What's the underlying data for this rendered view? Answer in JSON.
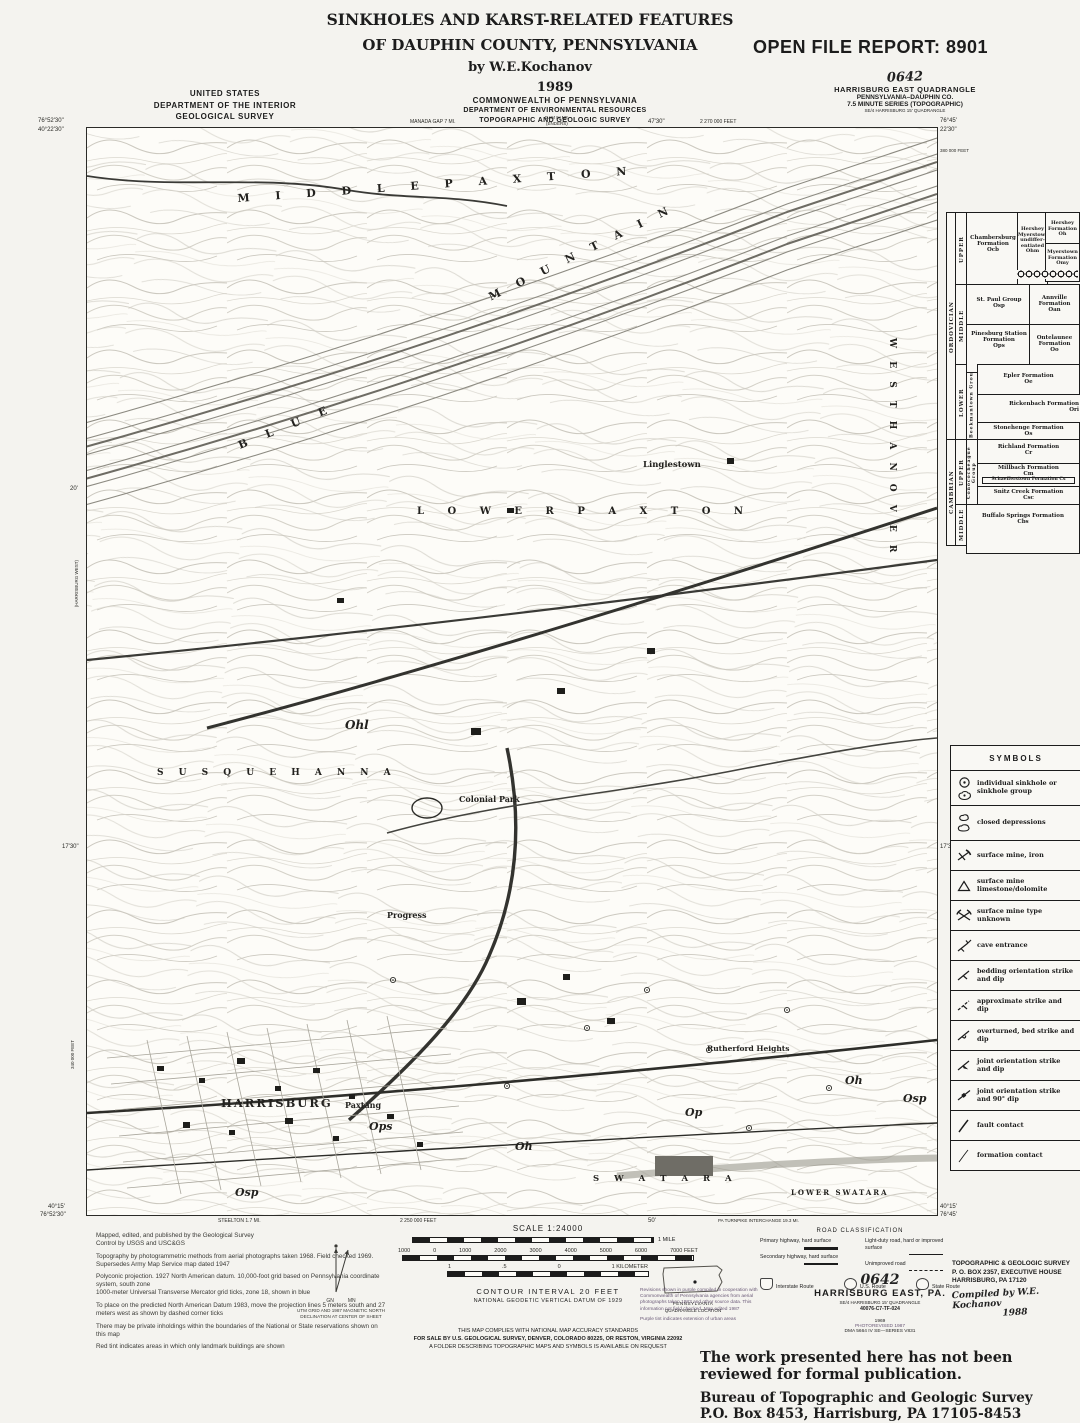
{
  "title_block": {
    "line1": "SINKHOLES AND KARST-RELATED FEATURES",
    "line2": "OF DAUPHIN COUNTY, PENNSYLVANIA",
    "byline": "by  W.E.Kochanov"
  },
  "open_file_report": "OPEN FILE REPORT: 8901",
  "agency_left": {
    "line1": "UNITED STATES",
    "line2": "DEPARTMENT OF THE INTERIOR",
    "line3": "GEOLOGICAL SURVEY"
  },
  "agency_center": {
    "year": "1989",
    "line1": "COMMONWEALTH OF PENNSYLVANIA",
    "line2": "DEPARTMENT OF ENVIRONMENTAL RESOURCES",
    "line3": "TOPOGRAPHIC AND GEOLOGIC SURVEY"
  },
  "quad_block": {
    "code": "0642",
    "line1": "HARRISBURG EAST QUADRANGLE",
    "line2": "PENNSYLVANIA–DAUPHIN CO.",
    "line3": "7.5 MINUTE SERIES (TOPOGRAPHIC)",
    "line4": "SE/4 HARRISBURG 15' QUADRANGLE"
  },
  "map": {
    "corners": {
      "nw_lon": "76°52'30\"",
      "nw_lat": "40°22'30\"",
      "ne_lon": "76°45'",
      "ne_lat": "22'30\"",
      "sw_lat": "40°15'",
      "sw_lon": "76°52'30\"",
      "se_lat": "40°15'",
      "se_lon": "76°45'"
    },
    "edge_ticks": {
      "top_left": "MANADA GAP 7 MI.",
      "top_quad1": "DAM IV NE",
      "top_quad2": "(ENDERS)",
      "top_center": "47'30\"",
      "top_feet": "2 270 000 FEET",
      "left_upper": "20'",
      "left_lower": "17'30\"",
      "left_feet": "340 000 FEET",
      "left_quad": "(HARRISBURG WEST)",
      "right_feet": "380 000 FEET",
      "right_mid": "17'30\"",
      "bottom_a": "STEELTON 1.7 MI.",
      "bottom_b": "2 250 000 FEET",
      "bottom_c": "50'",
      "bottom_d": "PA TURNPIKE INTERCHANGE 19.3 MI."
    },
    "labels": {
      "township_top": "M I D D L E   P A X T O N",
      "ridge1": "B L U E",
      "ridge2": "M O U N T A I N",
      "town1": "Linglestown",
      "township_mid": "L O W E R   P A X T O N",
      "township_right": "W E S T   H A N O V E R",
      "township_left": "S U S Q U E H A N N A",
      "town2": "Colonial Park",
      "town3": "Progress",
      "city": "HARRISBURG",
      "town4": "Paxtang",
      "town5": "Rutherford Heights",
      "township_bottom": "S W A T A R A",
      "township_br": "LOWER SWATARA"
    },
    "annotations": {
      "a1": "Ohl",
      "a2": "Ops",
      "a3": "Osp",
      "a4": "Oh",
      "a5": "Op",
      "a6": "Osp",
      "a7": "Oh"
    }
  },
  "strat": {
    "era1": "ORDOVICIAN",
    "era2": "CAMBRIAN",
    "epoch1": "UPPER",
    "epoch2": "MIDDLE",
    "epoch3": "LOWER",
    "epoch4": "UPPER",
    "epoch5": "MIDDLE",
    "group1": "Beekmantown Group",
    "group2": "Conococheague Group",
    "f1": "Chambersburg Formation",
    "f1c": "Ocb",
    "f2": "Hershey Myerstown undiffer- entiated",
    "f2c": "Ohm",
    "f3": "Hershey Formation",
    "f3c": "Oh",
    "f4": "Myerstown Formation",
    "f4c": "Omy",
    "f5": "St. Paul Group",
    "f5c": "Osp",
    "f6": "Annville Formation",
    "f6c": "Oan",
    "f7": "Pinesburg Station Formation",
    "f7c": "Ops",
    "f8": "Ontelaunee Formation",
    "f8c": "Oo",
    "f9": "Epler Formation",
    "f9c": "Oe",
    "f10": "Rickenbach Formation",
    "f10c": "Ori",
    "f11": "Stonehenge Formation",
    "f11c": "Os",
    "f12": "Richland Formation",
    "f12c": "Cr",
    "f13": "Millbach Formation",
    "f13c": "Cm",
    "f14": "Schaefferstown Formation",
    "f14c": "Cs",
    "f15": "Snitz Creek Formation",
    "f15c": "Csc",
    "f16": "Buffalo Springs Formation",
    "f16c": "Cbs"
  },
  "symbols_legend": {
    "title": "SYMBOLS",
    "items": [
      {
        "icon": "sinkhole-icon",
        "label": "individual sinkhole or sinkhole group"
      },
      {
        "icon": "closed-depression-icon",
        "label": "closed depressions"
      },
      {
        "icon": "surface-mine-iron-icon",
        "label": "surface mine, iron"
      },
      {
        "icon": "surface-mine-limestone-icon",
        "label": "surface mine limestone/dolomite"
      },
      {
        "icon": "surface-mine-unknown-icon",
        "label": "surface mine type unknown"
      },
      {
        "icon": "cave-entrance-icon",
        "label": "cave entrance"
      },
      {
        "icon": "bedding-strike-dip-icon",
        "label": "bedding orientation strike and dip"
      },
      {
        "icon": "approximate-strike-dip-icon",
        "label": "approximate strike and dip"
      },
      {
        "icon": "overturned-bed-icon",
        "label": "overturned, bed strike and dip"
      },
      {
        "icon": "joint-strike-dip-icon",
        "label": "joint orientation strike and dip"
      },
      {
        "icon": "joint-90-dip-icon",
        "label": "joint orientation strike and 90° dip"
      },
      {
        "icon": "fault-contact-icon",
        "label": "fault contact"
      },
      {
        "icon": "formation-contact-icon",
        "label": "formation contact"
      }
    ]
  },
  "footer": {
    "credits": [
      "Mapped, edited, and published by the Geological Survey",
      "Control by USGS and USC&GS",
      "Topography by photogrammetric methods from aerial photographs taken 1968.  Field checked 1969. Supersedes Army Map Service map dated 1947",
      "Polyconic projection.  1927 North American datum. 10,000-foot grid based on Pennsylvania coordinate system, south zone",
      "1000-meter Universal Transverse Mercator grid ticks, zone 18, shown in blue",
      "To place on the predicted North American Datum 1983, move the projection lines 5 meters south and 27 meters west as shown by dashed corner ticks",
      "There may be private inholdings within the boundaries of the National or State reservations shown on this map",
      "Red tint indicates areas in which only landmark buildings are shown"
    ],
    "gn": "GN",
    "mn": "MN",
    "declination1": "UTM GRID AND 1987 MAGNETIC NORTH",
    "declination2": "DECLINATION AT CENTER OF SHEET",
    "scale_label": "SCALE 1:24000",
    "scale_mile": "1 MILE",
    "feet": [
      "1000",
      "0",
      "1000",
      "2000",
      "3000",
      "4000",
      "5000",
      "6000",
      "7000 FEET"
    ],
    "km": [
      "1",
      ".5",
      "0",
      "1 KILOMETER"
    ],
    "contour": "CONTOUR INTERVAL 20 FEET",
    "datum": "NATIONAL GEODETIC VERTICAL DATUM OF 1929",
    "compliance": "THIS MAP COMPLIES WITH NATIONAL MAP ACCURACY STANDARDS",
    "sale": "FOR SALE BY U.S. GEOLOGICAL SURVEY, DENVER, COLORADO 80225, OR RESTON, VIRGINIA 22092",
    "folder": "A FOLDER DESCRIBING TOPOGRAPHIC MAPS AND SYMBOLS IS AVAILABLE ON REQUEST",
    "state": "PENNSYLVANIA",
    "quad_location": "QUADRANGLE LOCATION",
    "road": {
      "title": "ROAD CLASSIFICATION",
      "c1": "Primary highway, hard surface",
      "c2": "Secondary highway, hard surface",
      "c3": "Light-duty road, hard or improved surface",
      "c4": "Unimproved road",
      "s1": "Interstate Route",
      "s2": "U.S. Route",
      "s3": "State Route"
    },
    "sheet": {
      "code": "0642",
      "name": "HARRISBURG EAST, PA.",
      "sub": "SE/4 HARRISBURG 15' QUADRANGLE",
      "num": "40076-C7-TF-024",
      "year": "1969",
      "photorev": "PHOTOREVISED 1987",
      "dma": "DMA 5664 IV SE—SERIES V831"
    },
    "revisions": [
      "Revisions shown in purple compiled in cooperation with Commonwealth of Pennsylvania agencies from aerial photographs taken 1983 and other source data.  This information not field checked.  Map edited 1987",
      "Purple tint indicates extension of urban areas"
    ],
    "stamp": {
      "l1": "TOPOGRAPHIC & GEOLOGIC SURVEY",
      "l2": "P. O. BOX 2357, EXECUTIVE HOUSE",
      "l3": "HARRISBURG, PA  17120",
      "hand1": "Compiled by W.E. Kochanov",
      "hand2": "1988"
    },
    "notice": "The work presented here has not been reviewed for formal publication.",
    "bureau1": "Bureau of Topographic and Geologic Survey",
    "bureau2": "P.O. Box 8453, Harrisburg, PA  17105-8453"
  }
}
